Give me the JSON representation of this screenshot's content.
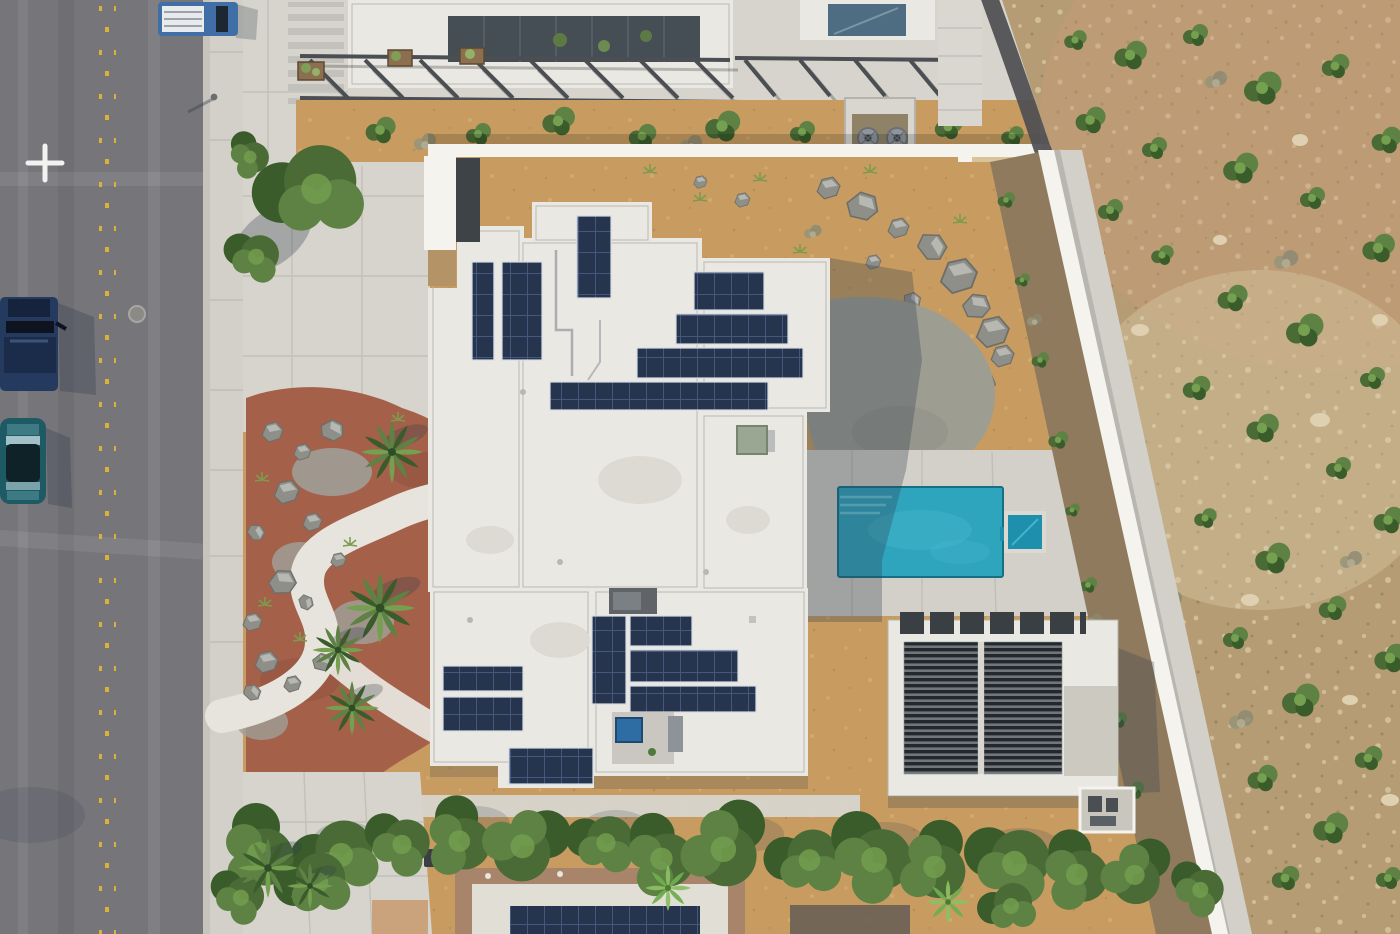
{
  "meta": {
    "title": "Aerial drone photo — modern desert home with rooftop solar",
    "description": "Top-down aerial photograph of a white flat-roofed modern house covered with rooftop solar panel arrays, a turquoise swimming pool with attached spa, a slatted shade pavilion, red-mulch desert landscaping with palms, boulders and a winding white path, a gray asphalt street with parked trucks on the left, a long white perimeter wall and a scrub-covered desert hillside on the right, and a green hedgerow with neighboring roofs along the bottom.",
    "view": "orthographic top-down aerial, daytime, hard sunlight",
    "image_width": 1400,
    "image_height": 934
  },
  "palette": {
    "road": "#76757a",
    "roadBand": "#8d8c90",
    "marking": "#d9b13b",
    "cross": "#f2f3f0",
    "curb": "#c6c4bd",
    "sidewalk": "#d2d0c8",
    "concrete": "#d6d4cc",
    "concreteSeam": "#b2b0a9",
    "sand": "#c89c61",
    "sandLight": "#dcb97e",
    "desert": "#b59c74",
    "desertPink": "#c89a79",
    "desertLight": "#ded0b0",
    "desertDark": "#8d7b5a",
    "dirt": "#8f7a5e",
    "wall": "#f4f3ee",
    "pathDark": "#4e4e52",
    "pathWhite": "#e6e4dc",
    "roof": "#e9e8e2",
    "roofLine": "#b5b3ac",
    "patio": "#c9c7bf",
    "panel": "#26344e",
    "panelGrid": "#44587e",
    "panelFrame": "#d7dde6",
    "pool": "#2ea4bd",
    "poolDeep": "#1f8fae",
    "poolLight": "#6fcadb",
    "poolEdge": "#157084",
    "mulch": "#a5604a",
    "gravel": "#a09f97",
    "boulder": "#8f8f8a",
    "boulderDark": "#6e6e69",
    "green1": "#4a6b35",
    "green2": "#5d8243",
    "green3": "#3a5c2b",
    "green4": "#74a050",
    "palmLight": "#8cc063",
    "dry": "#979478",
    "slat": "#24282c",
    "slatGap": "#70767c",
    "steel": "#4b4e52",
    "glass": "#454e55",
    "glassBlue": "#4e6d82",
    "skylight": "#2e6da4",
    "truckBlue": "#3f6fa6",
    "truckWhite": "#e8eaec",
    "navy": "#243a5e",
    "carTeal": "#1d5a63",
    "shadow": "#2e3c4c",
    "equip": "#8f959b",
    "wood": "#b49366",
    "binBlue": "#3f6db3",
    "binDark": "#3b3e42",
    "acGreen": "#9aa893",
    "boxGray": "#606468",
    "neighborTan": "#a8846b",
    "gravelRoof": "#e0ded5"
  },
  "scene": {
    "street": {
      "orientation": "vertical along left edge",
      "lane_marking": "double row of yellow raised dots down the center",
      "ground_marking": "white survey cross painted on asphalt",
      "manhole_count": 1
    },
    "vehicles": [
      {
        "type": "work truck with white rack",
        "position": "top of street, parked on right side"
      },
      {
        "type": "semi truck cab, dark blue",
        "position": "left edge, mid-upper"
      },
      {
        "type": "dark teal car",
        "position": "left edge below semi truck"
      }
    ],
    "main_house": {
      "roof": "white flat roof, multiple stepped parapet levels",
      "solar_arrays_count": 13,
      "rooftop_equipment": [
        "green AC unit",
        "gray mechanical box",
        "courtyard skylight (blue glass)",
        "vents",
        "conduit runs"
      ],
      "entry": "white fin wall with shaded glass entry and wood gate on west side"
    },
    "pool": {
      "shape": "rectangle",
      "color": "turquoise",
      "features": [
        "corner entry steps",
        "attached square spa on east side"
      ]
    },
    "pavilion": {
      "type": "shade structure",
      "roof": "two dark slatted panels in white concrete frame",
      "position": "southeast of house"
    },
    "landscaping": {
      "front_yard": "red-brown mulch with gray boulders, gravel patches, palms and a winding white concrete path",
      "palm_count": 8,
      "rear": "tan decomposed granite with boulder cluster and organic gray concrete pad"
    },
    "perimeter": {
      "north_wall": "long white block wall",
      "east_wall": "white block wall running diagonally with dirt planting strip, concrete sidewalk and dark asphalt trail",
      "east_terrain": "rocky desert hillside with green scrub"
    },
    "south_edge": {
      "hedgerow": "dense green trees/hedge across bottom",
      "neighbor_roof": "tan-parapet roof with white gravel and its own solar array",
      "bins": [
        "blue recycling bin",
        "two dark trash bins"
      ]
    }
  }
}
